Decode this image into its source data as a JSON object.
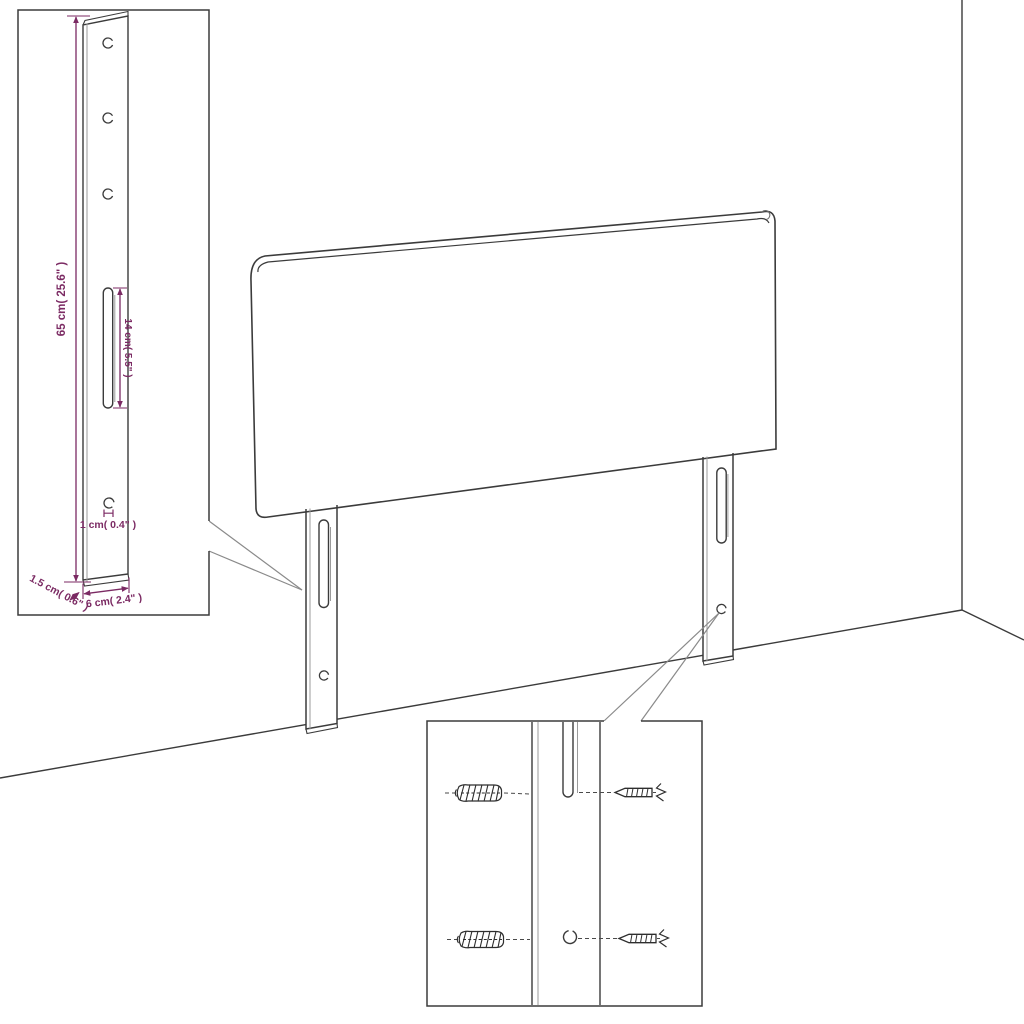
{
  "diagram": {
    "subject": "headboard-assembly-dimension-diagram",
    "dimensions": {
      "leg_height": "65 cm( 25.6\" )",
      "slot_length": "14 cm( 5.5\" )",
      "bottom_hole": "1 cm( 0.4\" )",
      "leg_thickness": "1.5 cm( 0.6\" )",
      "leg_width": "6 cm( 2.4\" )"
    },
    "colors": {
      "outline": "#3B3B3B",
      "dimension_text": "#7B2A63",
      "leader_line": "#8A8A8A"
    }
  }
}
